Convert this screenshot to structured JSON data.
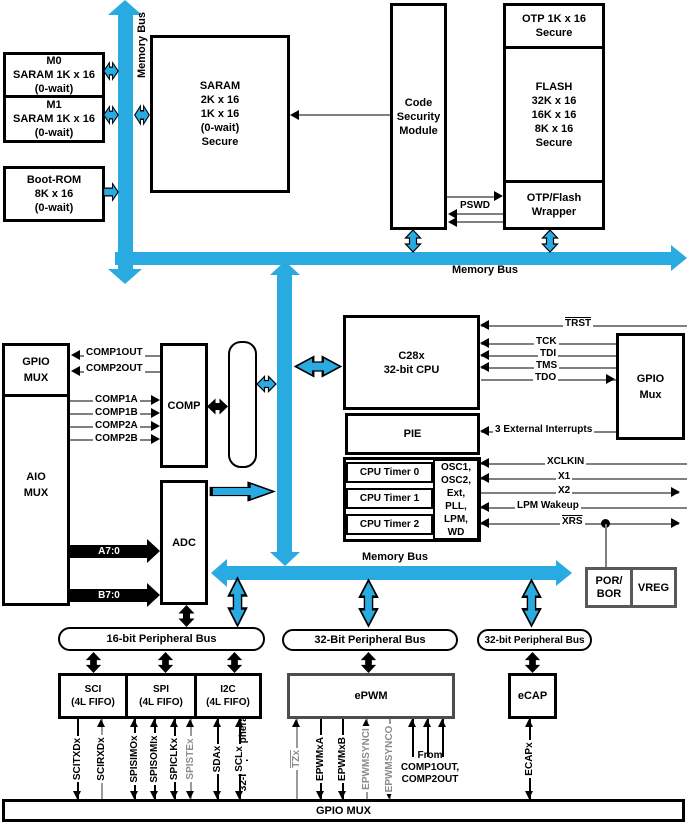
{
  "colors": {
    "bus_blue": "#29ABE2",
    "line_gray": "#808080",
    "muted_label_gray": "#8C8C8C",
    "epwm_border_gray": "#4D4D4D"
  },
  "buses": {
    "memory_vertical": "Memory Bus",
    "memory_top": "Memory Bus",
    "memory_mid": "Memory Bus",
    "peripheral_32_vertical": "32-bit peripheral bus",
    "peripheral_16": "16-bit Peripheral Bus",
    "peripheral_32_epwm": "32-Bit Peripheral Bus",
    "peripheral_32_ecap": "32-bit Peripheral Bus"
  },
  "blocks": {
    "m0": [
      "M0",
      "SARAM 1K x 16",
      "(0-wait)"
    ],
    "m1": [
      "M1",
      "SARAM 1K x 16",
      "(0-wait)"
    ],
    "boot_rom": [
      "Boot-ROM",
      "8K x 16",
      "(0-wait)"
    ],
    "saram": [
      "SARAM",
      "2K x 16",
      "1K x 16",
      "(0-wait)",
      "Secure"
    ],
    "code_security_module": [
      "Code",
      "Security",
      "Module"
    ],
    "otp": [
      "OTP 1K x 16",
      "Secure"
    ],
    "flash": [
      "FLASH",
      "32K x 16",
      "16K x 16",
      "8K x 16",
      "Secure"
    ],
    "otp_flash_wrapper": [
      "OTP/Flash",
      "Wrapper"
    ],
    "gpio_mux_left": [
      "GPIO",
      "MUX"
    ],
    "aio_mux": [
      "AIO",
      "MUX"
    ],
    "comp": "COMP",
    "adc": "ADC",
    "cpu": [
      "C28x",
      "32-bit CPU"
    ],
    "pie": "PIE",
    "timers": [
      "CPU Timer 0",
      "CPU Timer 1",
      "CPU Timer 2"
    ],
    "clocks": [
      "OSC1,",
      "OSC2,",
      "Ext,",
      "PLL,",
      "LPM,",
      "WD"
    ],
    "gpio_mux_right": [
      "GPIO",
      "Mux"
    ],
    "por_bor": [
      "POR/",
      "BOR"
    ],
    "vreg": "VREG",
    "sci": [
      "SCI",
      "(4L FIFO)"
    ],
    "spi": [
      "SPI",
      "(4L FIFO)"
    ],
    "i2c": [
      "I2C",
      "(4L FIFO)"
    ],
    "epwm": "ePWM",
    "ecap": "eCAP",
    "gpio_mux_bottom": "GPIO MUX"
  },
  "signals": {
    "comp_outputs": [
      "COMP1OUT",
      "COMP2OUT"
    ],
    "comp_inputs": [
      "COMP1A",
      "COMP1B",
      "COMP2A",
      "COMP2B"
    ],
    "adc_inputs": [
      "A7:0",
      "B7:0"
    ],
    "pswd": "PSWD",
    "jtag": [
      "TRST",
      "TCK",
      "TDI",
      "TMS",
      "TDO"
    ],
    "interrupts": "3 External Interrupts",
    "clock_pins": [
      "XCLKIN",
      "X1",
      "X2",
      "LPM Wakeup",
      "XRS"
    ],
    "sci_pins": [
      "SCITXDx",
      "SCIRXDx"
    ],
    "spi_pins": [
      "SPISIMOx",
      "SPISOMIx",
      "SPICLKx",
      "SPISTEx"
    ],
    "i2c_pins": [
      "SDAx",
      "SCLx"
    ],
    "epwm_pins": [
      "TZx",
      "EPWMxA",
      "EPWMxB",
      "EPWMSYNCI",
      "EPWMSYNCO"
    ],
    "from_comp": [
      "From",
      "COMP1OUT,",
      "COMP2OUT"
    ],
    "ecap_pin": "ECAPx"
  }
}
